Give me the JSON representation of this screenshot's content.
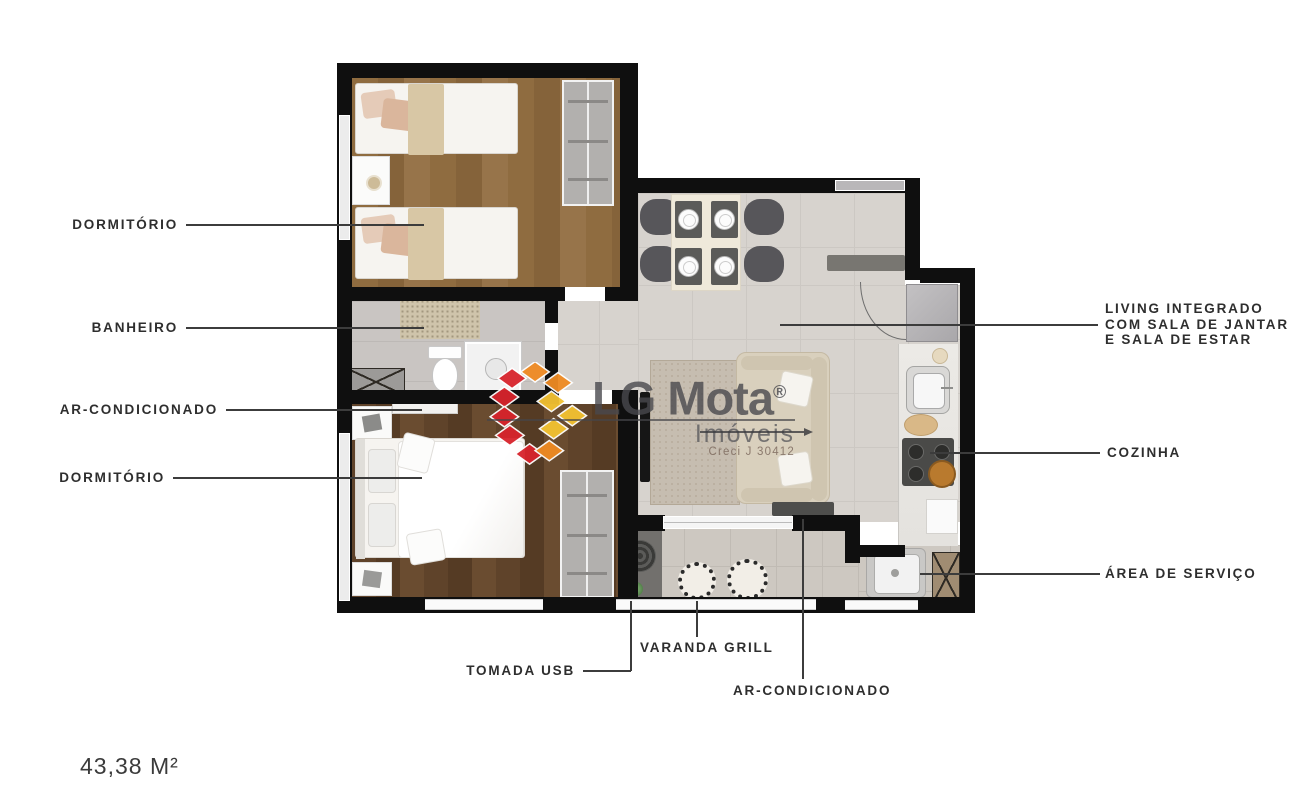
{
  "area_label": "43,38 M²",
  "watermark": {
    "brand": "LG Mota",
    "registered_mark": "®",
    "subtitle": "Imóveis",
    "license": "Creci J 30412",
    "colors": {
      "red": "#d8242c",
      "orange": "#ef8b23",
      "yellow": "#f3c232",
      "text_gray": "#636366"
    }
  },
  "callouts": {
    "dormitorio_1": "DORMITÓRIO",
    "banheiro": "BANHEIRO",
    "ar_condicionado_1": "AR-CONDICIONADO",
    "dormitorio_2": "DORMITÓRIO",
    "living_line1": "LIVING INTEGRADO",
    "living_line2": "COM SALA DE JANTAR",
    "living_line3": "E SALA DE ESTAR",
    "cozinha": "COZINHA",
    "area_servico": "ÁREA DE SERVIÇO",
    "varanda_grill": "VARANDA GRILL",
    "tomada_usb": "TOMADA USB",
    "ar_condicionado_2": "AR-CONDICIONADO"
  },
  "plan_colors": {
    "wall": "#0f0f0f",
    "wood_light": "#8f6c40",
    "wood_dark": "#5f432a",
    "tile": "#d7d3ce",
    "leader_line": "#3c3c3c"
  }
}
